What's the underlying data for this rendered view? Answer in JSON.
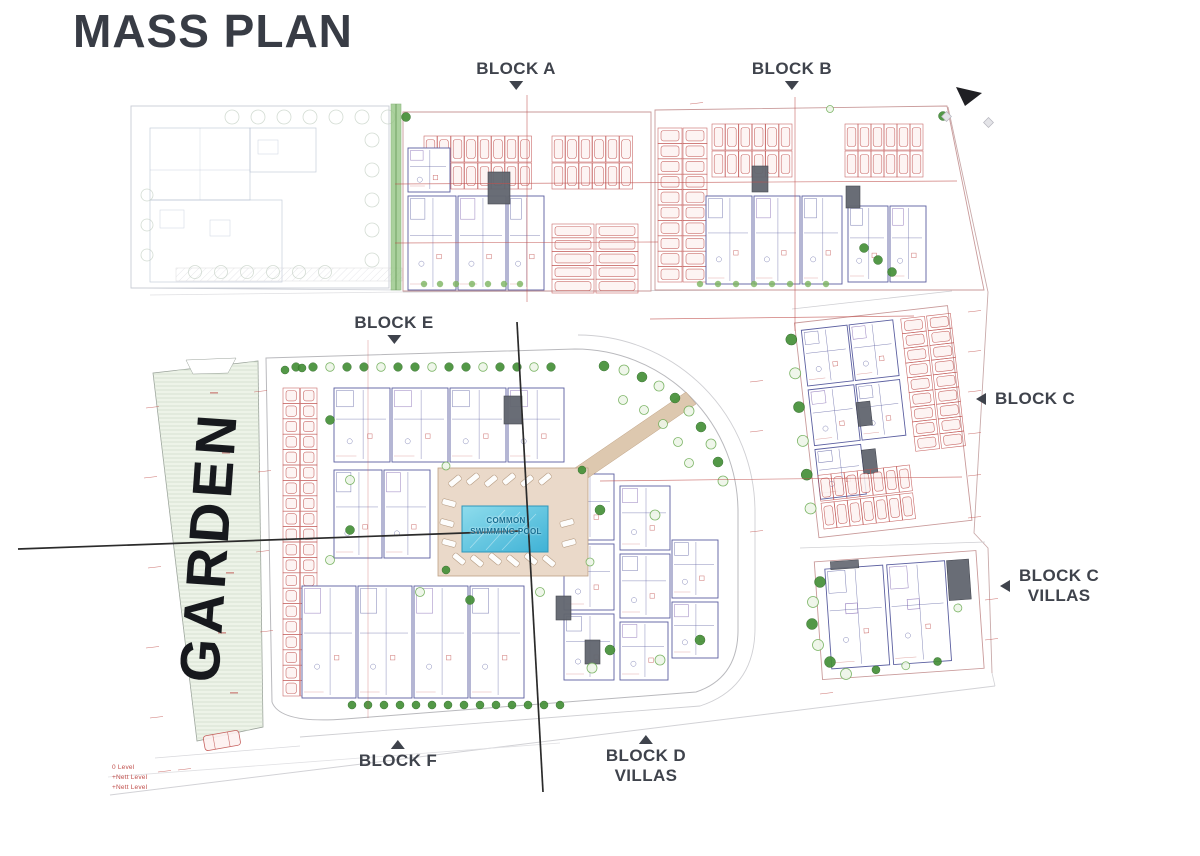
{
  "title": "MASS PLAN",
  "labels": {
    "block_a": "BLOCK A",
    "block_b": "BLOCK B",
    "block_e": "BLOCK E",
    "block_f": "BLOCK F",
    "block_c": "BLOCK C",
    "block_c_villas_1": "BLOCK C",
    "block_c_villas_2": "VILLAS",
    "block_d_1": "BLOCK D",
    "block_d_2": "VILLAS",
    "garden": "GARDEN",
    "pool_1": "COMMON",
    "pool_2": "SWIMMING POOL"
  },
  "annotations": {
    "level_note_lines": [
      "0 Level",
      "+Nett Level",
      "+Nett Level"
    ]
  },
  "colors": {
    "label_text": "#3f434c",
    "title_text": "#383c45",
    "cad_red": "#c0504d",
    "cad_navy": "#5b5fa0",
    "cad_purple": "#7a5fae",
    "tree_green": "#459038",
    "tree_light": "#6fae57",
    "garden_fill": "#edf3e8",
    "deck_tan": "#ead9c9",
    "pool_blue": "#6fcbe3",
    "pool_deep": "#3fb0d4",
    "pool_text": "#176f92",
    "section_line": "#2b2b2b",
    "road_gray": "#cfcfd3",
    "boundary_red": "#c99a9a",
    "core_gray": "#62666f"
  }
}
